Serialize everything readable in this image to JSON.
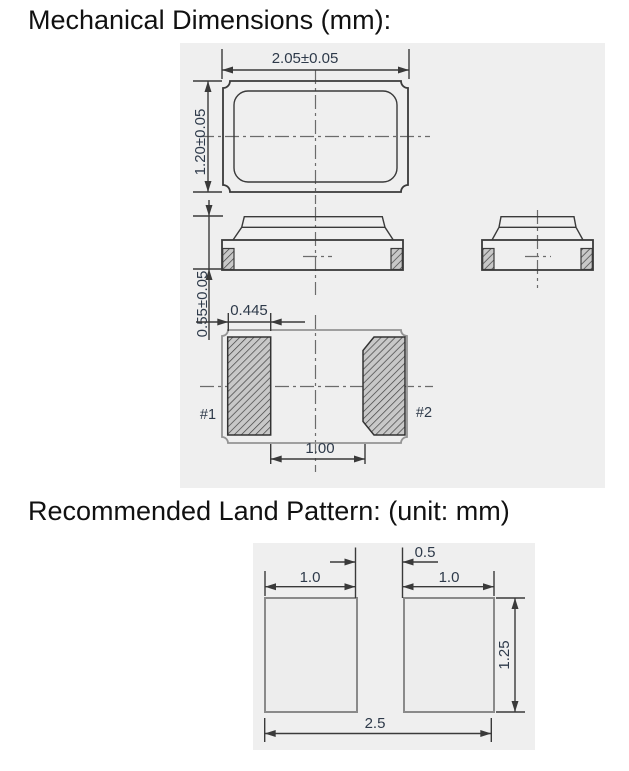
{
  "mechanical": {
    "title": "Mechanical Dimensions (mm):",
    "top_view": {
      "body_width": "2.05±0.05",
      "body_height": "1.20±0.05"
    },
    "side_view": {
      "thickness": "0.55±0.05"
    },
    "bottom_view": {
      "pad_width": "0.445",
      "pad_spacing": "1.00",
      "pad1_label": "#1",
      "pad2_label": "#2"
    }
  },
  "land_pattern": {
    "title": "Recommended Land Pattern: (unit: mm)",
    "gap": "0.5",
    "left_pad_width": "1.0",
    "right_pad_width": "1.0",
    "pad_height": "1.25",
    "overall_width": "2.5"
  },
  "colors": {
    "panel_background": "#efefef",
    "drawing_line": "#3a3a3a",
    "dimension_text": "#2e3a4a",
    "hidden_outline_gray": "#949494",
    "hatch_fill": "#c8c8c8",
    "land_pad_border": "#8a8a8a",
    "title_text": "#111111"
  }
}
